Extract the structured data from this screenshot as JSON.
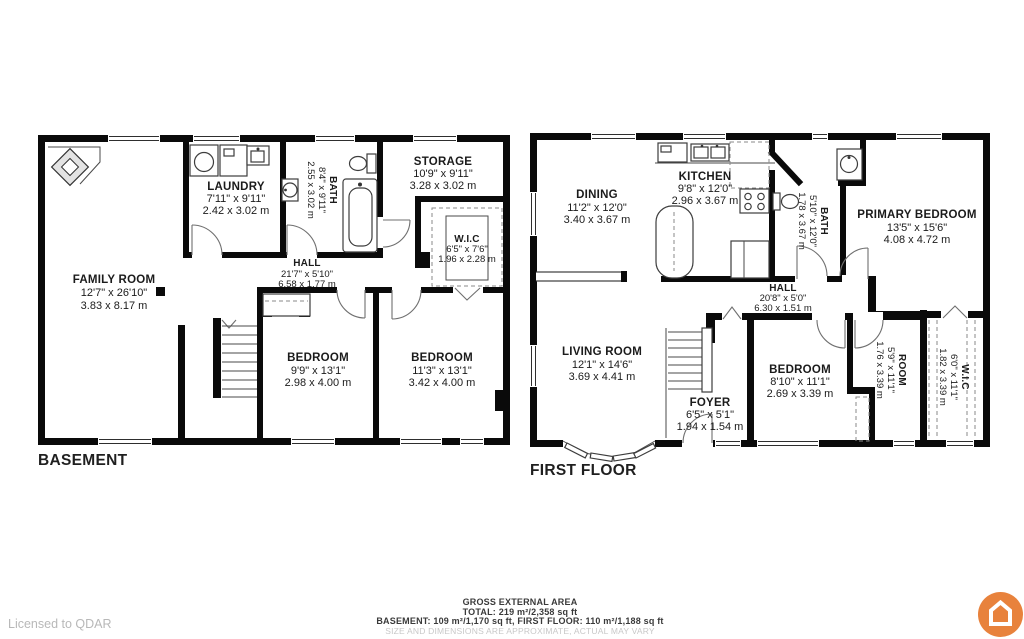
{
  "plans": [
    {
      "title": "BASEMENT",
      "rooms": [
        {
          "name": "FAMILY ROOM",
          "imperial": "12'7\" x 26'10\"",
          "metric": "3.83 x 8.17 m"
        },
        {
          "name": "LAUNDRY",
          "imperial": "7'11\" x 9'11\"",
          "metric": "2.42 x 3.02 m"
        },
        {
          "name": "BATH",
          "imperial": "8'4\" x 9'11\"",
          "metric": "2.55 x 3.02 m"
        },
        {
          "name": "STORAGE",
          "imperial": "10'9\" x 9'11\"",
          "metric": "3.28 x 3.02 m"
        },
        {
          "name": "W.I.C",
          "imperial": "6'5\" x 7'6\"",
          "metric": "1.96 x 2.28 m"
        },
        {
          "name": "HALL",
          "imperial": "21'7\" x 5'10\"",
          "metric": "6.58 x 1.77 m"
        },
        {
          "name": "BEDROOM",
          "imperial": "9'9\" x 13'1\"",
          "metric": "2.98 x 4.00 m"
        },
        {
          "name": "BEDROOM",
          "imperial": "11'3\" x 13'1\"",
          "metric": "3.42 x 4.00 m"
        }
      ]
    },
    {
      "title": "FIRST FLOOR",
      "rooms": [
        {
          "name": "DINING",
          "imperial": "11'2\" x 12'0\"",
          "metric": "3.40 x 3.67 m"
        },
        {
          "name": "KITCHEN",
          "imperial": "9'8\" x 12'0\"",
          "metric": "2.96 x 3.67 m"
        },
        {
          "name": "BATH",
          "imperial": "5'10\" x 12'0\"",
          "metric": "1.78 x 3.67 m"
        },
        {
          "name": "PRIMARY BEDROOM",
          "imperial": "13'5\" x 15'6\"",
          "metric": "4.08 x 4.72 m"
        },
        {
          "name": "HALL",
          "imperial": "20'8\" x 5'0\"",
          "metric": "6.30 x 1.51 m"
        },
        {
          "name": "LIVING ROOM",
          "imperial": "12'1\" x 14'6\"",
          "metric": "3.69 x 4.41 m"
        },
        {
          "name": "FOYER",
          "imperial": "6'5\" x 5'1\"",
          "metric": "1.94 x 1.54 m"
        },
        {
          "name": "BEDROOM",
          "imperial": "8'10\" x 11'1\"",
          "metric": "2.69 x 3.39 m"
        },
        {
          "name": "ROOM",
          "imperial": "5'9\" x 11'1\"",
          "metric": "1.76 x 3.39 m"
        },
        {
          "name": "W.I.C",
          "imperial": "6'0\" x 11'1\"",
          "metric": "1.82 x 3.39 m"
        }
      ]
    }
  ],
  "footer": {
    "license": "Licensed to QDAR",
    "area_title": "GROSS EXTERNAL AREA",
    "total": "TOTAL: 219 m²/2,358 sq ft",
    "breakdown": "BASEMENT: 109 m²/1,170 sq ft, FIRST FLOOR: 110 m²/1,188 sq ft",
    "disclaimer": "SIZE AND DIMENSIONS ARE APPROXIMATE, ACTUAL MAY VARY"
  },
  "logo": {
    "icon": "house-icon",
    "color": "#E8823C"
  }
}
